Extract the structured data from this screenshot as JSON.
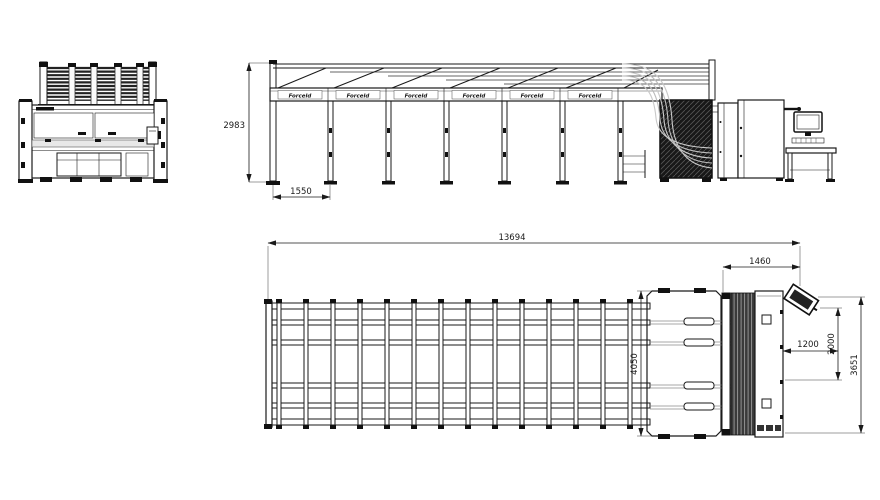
{
  "page": {
    "background": "#ffffff"
  },
  "drawing": {
    "type": "machine-installation-technical-drawing",
    "colors": {
      "line": "#1a1a1a",
      "line_light": "#8a8a8a",
      "hatch_dark": "#181818",
      "background": "#ffffff"
    },
    "side_view": {
      "beam_label": "Forceld",
      "dim_height": "2983",
      "dim_bay": "1550"
    },
    "plan_view": {
      "dim_total_length": "13694",
      "dim_machine_width": "1460",
      "dim_conveyor_width": "4050",
      "dim_offset": "1200",
      "dim_table_width": "2000",
      "dim_overall_width": "3651"
    }
  }
}
